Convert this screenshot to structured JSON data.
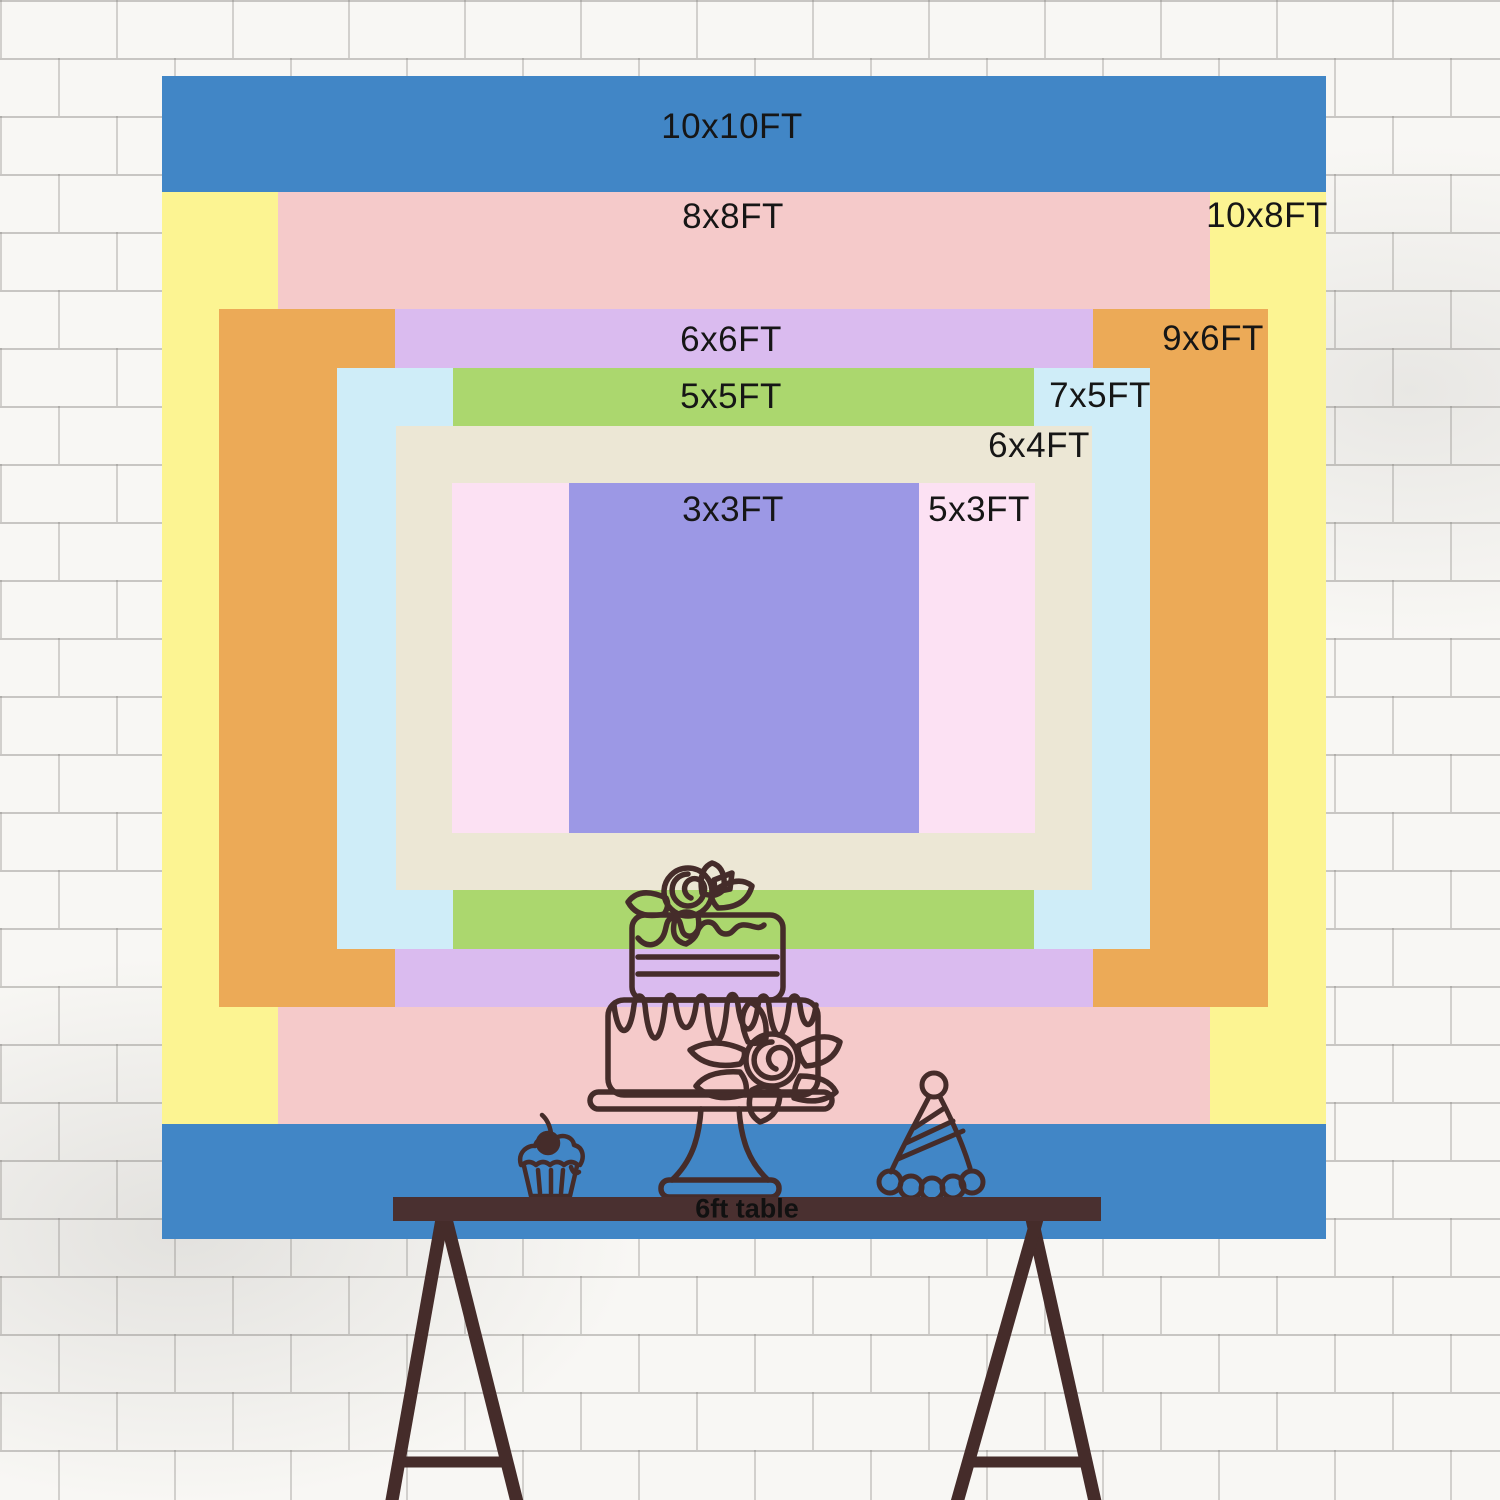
{
  "canvas": {
    "width": 1500,
    "height": 1500
  },
  "colors": {
    "wall_background": "#f8f7f4",
    "mortar_line": "#b9b6b2",
    "line_art": "#452c2a",
    "table_bar": "#4a3030",
    "label_text": "#161616"
  },
  "backdrop_layers": [
    {
      "id": "10x10",
      "label": "10x10FT",
      "color": "#4186c6",
      "x": 162,
      "y": 76,
      "w": 1164,
      "h": 1163,
      "label_cx": 732,
      "label_cy": 127
    },
    {
      "id": "10x8",
      "label": "10x8FT",
      "color": "#fcf492",
      "x": 162,
      "y": 192,
      "w": 1164,
      "h": 932,
      "label_cx": 1267,
      "label_cy": 216
    },
    {
      "id": "8x8",
      "label": "8x8FT",
      "color": "#f5caca",
      "x": 278,
      "y": 192,
      "w": 932,
      "h": 932,
      "label_cx": 733,
      "label_cy": 217
    },
    {
      "id": "9x6",
      "label": "9x6FT",
      "color": "#ecaa57",
      "x": 219,
      "y": 309,
      "w": 1049,
      "h": 698,
      "label_cx": 1213,
      "label_cy": 339
    },
    {
      "id": "6x6",
      "label": "6x6FT",
      "color": "#dabbef",
      "x": 395,
      "y": 309,
      "w": 698,
      "h": 698,
      "label_cx": 731,
      "label_cy": 340
    },
    {
      "id": "7x5",
      "label": "7x5FT",
      "color": "#cfedf8",
      "x": 337,
      "y": 368,
      "w": 813,
      "h": 581,
      "label_cx": 1100,
      "label_cy": 396
    },
    {
      "id": "5x5",
      "label": "5x5FT",
      "color": "#abd76e",
      "x": 453,
      "y": 368,
      "w": 581,
      "h": 581,
      "label_cx": 731,
      "label_cy": 397
    },
    {
      "id": "6x4",
      "label": "6x4FT",
      "color": "#ece7d5",
      "x": 396,
      "y": 426,
      "w": 696,
      "h": 464,
      "label_cx": 1039,
      "label_cy": 446
    },
    {
      "id": "5x3",
      "label": "5x3FT",
      "color": "#fce1f3",
      "x": 452,
      "y": 483,
      "w": 583,
      "h": 350,
      "label_cx": 979,
      "label_cy": 510
    },
    {
      "id": "3x3",
      "label": "3x3FT",
      "color": "#9c98e5",
      "x": 569,
      "y": 483,
      "w": 350,
      "h": 350,
      "label_cx": 733,
      "label_cy": 510
    }
  ],
  "table": {
    "label": "6ft table"
  },
  "decorations": [
    "tiered-cake-icon",
    "cupcake-icon",
    "party-hat-icon",
    "trestle-table-legs"
  ]
}
